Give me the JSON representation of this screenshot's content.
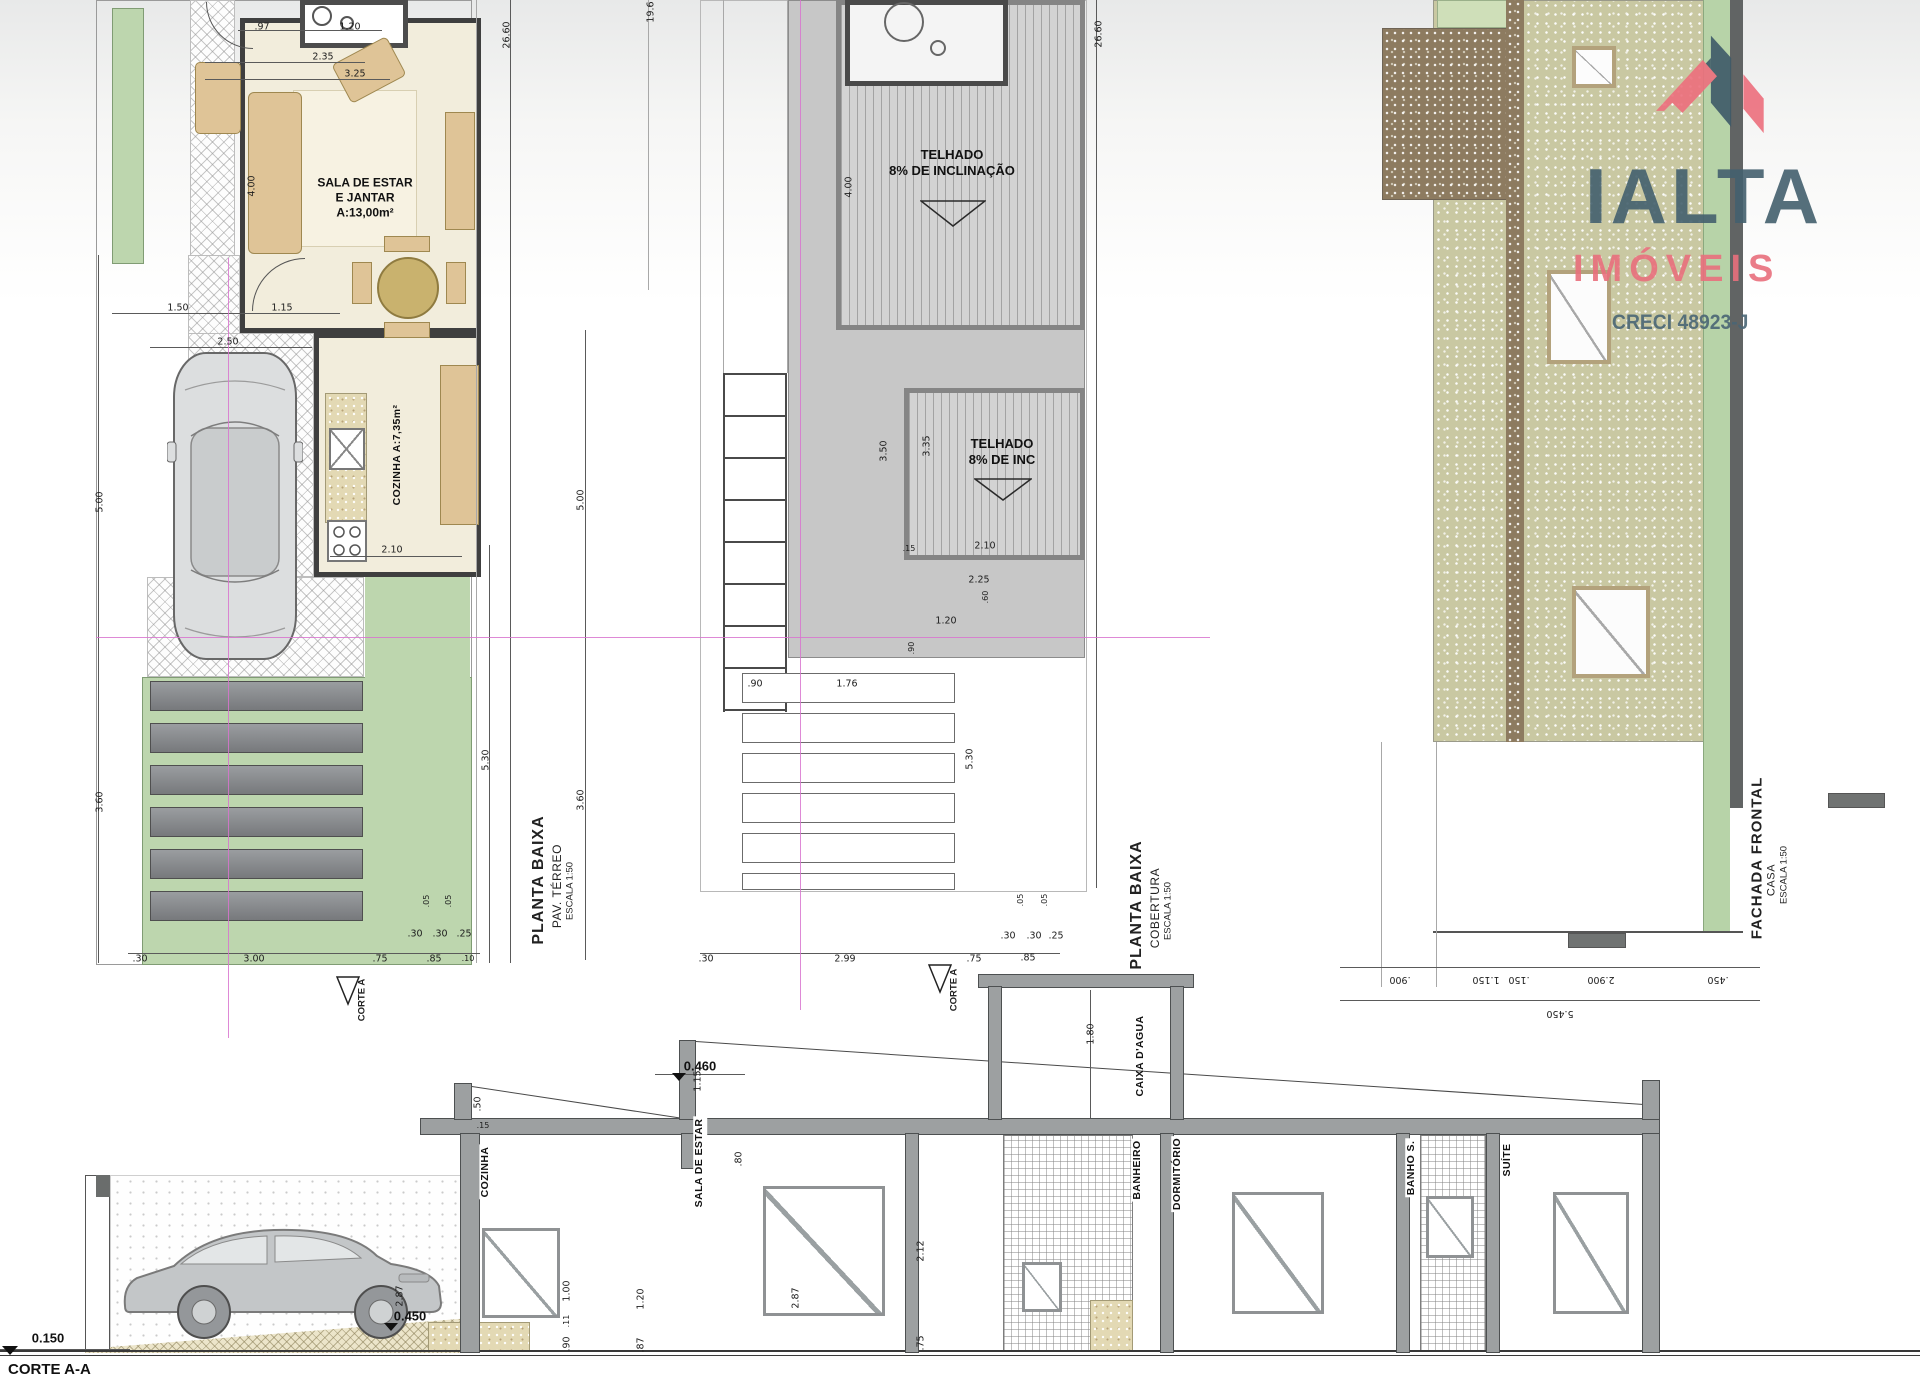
{
  "logo": {
    "title": "IALTA",
    "subtitle": "IMÓVEIS",
    "creci": "CRECI 48923-J",
    "colors": {
      "slate": "#44606e",
      "pink": "#e9707d"
    }
  },
  "plans": {
    "terreo": {
      "title": "PLANTA BAIXA",
      "subtitle": "PAV. TÉRREO",
      "scale": "ESCALA 1:50",
      "sala": {
        "l1": "SALA DE ESTAR",
        "l2": "E JANTAR",
        "area": "A:13,00m²"
      },
      "cozinha": {
        "l1": "COZINHA",
        "area": "A:7,35m²"
      },
      "corte_marker": "CORTE A",
      "dims": [
        ".97",
        "1.20",
        "2.35",
        "3.25",
        "26.60",
        "4.00",
        "1.50",
        "1.15",
        "2.50",
        "5.00",
        "2.10",
        "3.60",
        "5.30",
        ".30",
        "3.00",
        ".75",
        ".85",
        ".30",
        ".30",
        ".25",
        ".05",
        ".05",
        ".10"
      ]
    },
    "cobertura": {
      "title": "PLANTA BAIXA",
      "subtitle": "COBERTURA",
      "scale": "ESCALA 1:50",
      "roof1": {
        "l1": "TELHADO",
        "l2": "8% DE INCLINAÇÃO"
      },
      "roof2": {
        "l1": "TELHADO",
        "l2": "8% DE INC"
      },
      "corte_marker": "CORTE A",
      "dims": [
        "19.6",
        "26.60",
        "4.00",
        "3.50",
        "3.35",
        ".15",
        "2.10",
        "2.25",
        ".60",
        "1.20",
        ".90",
        ".90",
        "1.76",
        "5.00",
        "3.60",
        "5.30",
        ".30",
        "2.99",
        ".75",
        ".85",
        ".30",
        ".30",
        ".25",
        ".05",
        ".05"
      ]
    },
    "fachada": {
      "title": "FACHADA FRONTAL",
      "subtitle": "CASA",
      "scale": "ESCALA 1:50",
      "dims": [
        ".900",
        "1.150",
        ".150",
        "2.900",
        ".450",
        "5.450"
      ]
    },
    "corte": {
      "title": "CORTE A-A",
      "rooms": [
        "COZINHA",
        "SALA DE ESTAR",
        "BANHEIRO",
        "DORMITÓRIO",
        "BANHO S.",
        "SUÍTE"
      ],
      "caixa": "CAIXA D'AGUA",
      "levels": [
        "0.150",
        "0.450",
        "0.460"
      ],
      "dims": [
        "2.87",
        "1.00",
        ".11",
        ".90",
        ".50",
        ".15",
        "1.15",
        ".80",
        "2.87",
        "1.20",
        ".87",
        "2.12",
        ".75",
        "1.80"
      ]
    }
  }
}
